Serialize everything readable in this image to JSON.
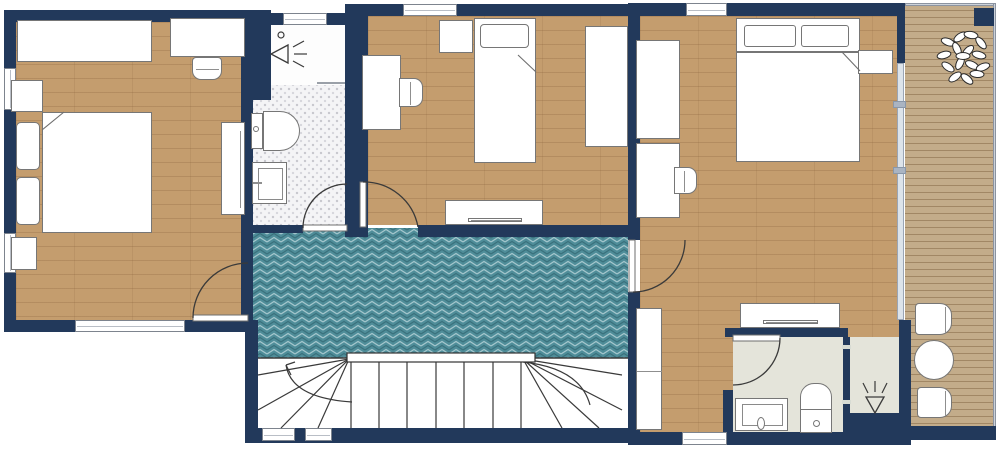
{
  "meta": {
    "title": "apartment-upper-floor-plan",
    "visible_text": []
  },
  "colors": {
    "wall": "#22395b",
    "wood": "#c49d6e",
    "deck": "#c3ac8a",
    "teal": "#4f8d99",
    "tile": "#f4f4f6",
    "ensuite": "#e4e4da",
    "floorwhite": "#fdfdfd",
    "furnborder": "#767676",
    "line": "#3a3a3a",
    "glass": "#dce3ea"
  },
  "plan": {
    "floors": [
      {
        "name": "bedroom-left",
        "type": "wood",
        "rect": [
          16,
          22,
          225,
          298
        ]
      },
      {
        "name": "bathroom1-shower",
        "type": "white",
        "rect": [
          271,
          25,
          74,
          60
        ]
      },
      {
        "name": "bathroom1-tile",
        "type": "tile",
        "rect": [
          253,
          85,
          92,
          143
        ]
      },
      {
        "name": "bedroom-middle",
        "type": "wood",
        "rect": [
          368,
          16,
          260,
          209
        ]
      },
      {
        "name": "hallway",
        "type": "herringbone",
        "rect": [
          253,
          228,
          375,
          130
        ]
      },
      {
        "name": "stairwell",
        "type": "stairs",
        "rect": [
          258,
          358,
          370,
          70
        ]
      },
      {
        "name": "bedroom-right",
        "type": "wood",
        "rect": [
          640,
          16,
          261,
          416
        ]
      },
      {
        "name": "ensuite-main",
        "type": "ensuite",
        "rect": [
          733,
          337,
          110,
          96
        ]
      },
      {
        "name": "ensuite-shower",
        "type": "ensuite",
        "rect": [
          850,
          337,
          55,
          76
        ]
      },
      {
        "name": "balcony-deck",
        "type": "deck",
        "rect": [
          905,
          3,
          91,
          429
        ]
      }
    ],
    "walls": [
      {
        "name": "wall-top-left",
        "rect": [
          4,
          10,
          249,
          12
        ]
      },
      {
        "name": "wall-left",
        "rect": [
          4,
          10,
          12,
          322
        ]
      },
      {
        "name": "wall-bottom-left",
        "rect": [
          4,
          320,
          249,
          12
        ]
      },
      {
        "name": "wall-bedroom1-right",
        "rect": [
          241,
          10,
          12,
          322
        ]
      },
      {
        "name": "wall-shower1-block",
        "rect": [
          241,
          10,
          30,
          90
        ]
      },
      {
        "name": "wall-bath1-top",
        "rect": [
          253,
          13,
          102,
          12
        ]
      },
      {
        "name": "wall-bath1-right",
        "rect": [
          345,
          4,
          23,
          233
        ]
      },
      {
        "name": "wall-middle-top",
        "rect": [
          348,
          4,
          292,
          12
        ]
      },
      {
        "name": "wall-middle-bottom-a",
        "rect": [
          355,
          225,
          7,
          12
        ]
      },
      {
        "name": "wall-middle-bottom-b",
        "rect": [
          418,
          225,
          222,
          12
        ]
      },
      {
        "name": "wall-bath1-bottom",
        "rect": [
          253,
          225,
          50,
          8
        ]
      },
      {
        "name": "wall-stairs-left",
        "rect": [
          245,
          320,
          13,
          123
        ]
      },
      {
        "name": "wall-stairs-bottom",
        "rect": [
          245,
          428,
          395,
          15
        ]
      },
      {
        "name": "wall-divider-upper",
        "rect": [
          628,
          4,
          12,
          236
        ]
      },
      {
        "name": "wall-divider-lower",
        "rect": [
          628,
          292,
          12,
          153
        ]
      },
      {
        "name": "wall-right-top",
        "rect": [
          628,
          3,
          277,
          13
        ]
      },
      {
        "name": "wall-right-bottom",
        "rect": [
          628,
          432,
          283,
          13
        ]
      },
      {
        "name": "wall-balcony-upper",
        "rect": [
          897,
          3,
          8,
          60
        ]
      },
      {
        "name": "wall-balcony-lower",
        "rect": [
          899,
          320,
          12,
          125
        ]
      },
      {
        "name": "wall-ensuite-top",
        "rect": [
          725,
          328,
          123,
          9
        ]
      },
      {
        "name": "wall-ensuite-left",
        "rect": [
          723,
          390,
          10,
          43
        ]
      },
      {
        "name": "wall-ensuite-divider",
        "rect": [
          843,
          337,
          7,
          96
        ]
      },
      {
        "name": "wall-shower2-bottom",
        "rect": [
          848,
          413,
          63,
          32
        ]
      },
      {
        "name": "wall-balcony-bottom",
        "rect": [
          905,
          426,
          91,
          14
        ]
      },
      {
        "name": "wall-balcony-pillar",
        "rect": [
          974,
          8,
          20,
          18
        ]
      }
    ],
    "windows": [
      {
        "name": "window-bedroom1-left-a",
        "rect": [
          4,
          68,
          12,
          42
        ]
      },
      {
        "name": "window-bedroom1-left-b",
        "rect": [
          4,
          233,
          12,
          40
        ]
      },
      {
        "name": "window-bedroom1-bottom",
        "rect": [
          75,
          320,
          110,
          12
        ]
      },
      {
        "name": "window-bathroom1-top",
        "rect": [
          283,
          13,
          44,
          12
        ]
      },
      {
        "name": "window-bedroom2-top",
        "rect": [
          403,
          4,
          54,
          12
        ]
      },
      {
        "name": "window-bedroom3-top",
        "rect": [
          686,
          3,
          41,
          13
        ]
      },
      {
        "name": "window-bedroom3-bottom",
        "rect": [
          682,
          432,
          45,
          13
        ]
      },
      {
        "name": "window-stairwell-a",
        "rect": [
          262,
          428,
          33,
          13
        ]
      },
      {
        "name": "window-stairwell-b",
        "rect": [
          305,
          428,
          27,
          13
        ]
      }
    ],
    "glass_door": {
      "name": "balcony-sliding-door",
      "rect": [
        897,
        63,
        7,
        257
      ],
      "handles": [
        [
          893,
          101,
          13,
          7
        ],
        [
          893,
          167,
          13,
          7
        ]
      ]
    },
    "railings": [
      {
        "name": "balcony-railing-top",
        "rect": [
          905,
          3,
          91,
          3
        ]
      },
      {
        "name": "balcony-railing-right",
        "rect": [
          993,
          3,
          3,
          434
        ]
      }
    ],
    "furniture": [
      {
        "name": "bedroom1-wardrobe",
        "rect": [
          17,
          20,
          135,
          42
        ]
      },
      {
        "name": "bedroom1-desk",
        "rect": [
          170,
          18,
          75,
          39
        ]
      },
      {
        "name": "bedroom1-desk-chair",
        "rect": [
          192,
          57,
          30,
          23
        ],
        "radius": "4px 4px 9px 9px",
        "bar": [
          3,
          11,
          23,
          1
        ]
      },
      {
        "name": "bedroom1-nightstand-a",
        "rect": [
          11,
          80,
          32,
          32
        ]
      },
      {
        "name": "bedroom1-pillow-a",
        "rect": [
          16,
          122,
          24,
          48
        ],
        "radius": "5px"
      },
      {
        "name": "bedroom1-pillow-b",
        "rect": [
          16,
          177,
          24,
          48
        ],
        "radius": "5px"
      },
      {
        "name": "bedroom1-double-bed",
        "rect": [
          42,
          112,
          110,
          121
        ]
      },
      {
        "name": "bedroom1-tall-cabinet",
        "rect": [
          221,
          122,
          24,
          93
        ],
        "bar": [
          18,
          8,
          1,
          77
        ]
      },
      {
        "name": "bedroom1-nightstand-b",
        "rect": [
          11,
          237,
          26,
          33
        ]
      },
      {
        "name": "bathroom1-toilet-tank",
        "rect": [
          251,
          113,
          12,
          36
        ]
      },
      {
        "name": "bathroom1-toilet-bowl",
        "rect": [
          263,
          111,
          37,
          40
        ],
        "radius": "0 20px 20px 0"
      },
      {
        "name": "bathroom1-toilet-button",
        "rect": [
          253,
          126,
          6,
          6
        ],
        "radius": "50%"
      },
      {
        "name": "bathroom1-sink",
        "rect": [
          252,
          162,
          35,
          42
        ],
        "inner": [
          5,
          5,
          25,
          32
        ],
        "bar": [
          0,
          19,
          9,
          2
        ]
      },
      {
        "name": "bedroom2-cabinet",
        "rect": [
          439,
          20,
          34,
          33
        ]
      },
      {
        "name": "bedroom2-single-bed",
        "rect": [
          474,
          18,
          62,
          145
        ]
      },
      {
        "name": "bedroom2-pillow",
        "rect": [
          480,
          24,
          49,
          24
        ],
        "radius": "4px"
      },
      {
        "name": "bedroom2-desk",
        "rect": [
          362,
          55,
          39,
          75
        ]
      },
      {
        "name": "bedroom2-desk-chair",
        "rect": [
          399,
          78,
          24,
          29
        ],
        "radius": "0 9px 9px 0",
        "bar": [
          10,
          3,
          1,
          23
        ]
      },
      {
        "name": "bedroom2-wardrobe",
        "rect": [
          585,
          26,
          43,
          121
        ]
      },
      {
        "name": "bedroom2-tv-cabinet",
        "rect": [
          445,
          200,
          98,
          25
        ]
      },
      {
        "name": "bedroom2-tv",
        "rect": [
          468,
          218,
          54,
          4
        ],
        "bar": [
          2,
          1,
          50,
          1
        ]
      },
      {
        "name": "bedroom3-wardrobe-a",
        "rect": [
          636,
          40,
          44,
          99
        ]
      },
      {
        "name": "bedroom3-desk",
        "rect": [
          636,
          143,
          44,
          75
        ]
      },
      {
        "name": "bedroom3-desk-chair",
        "rect": [
          674,
          167,
          23,
          27
        ],
        "radius": "0 9px 9px 0",
        "bar": [
          9,
          3,
          1,
          21
        ]
      },
      {
        "name": "bedroom3-headboard",
        "rect": [
          736,
          18,
          124,
          34
        ]
      },
      {
        "name": "bedroom3-pillow-a",
        "rect": [
          744,
          25,
          52,
          22
        ],
        "radius": "3px"
      },
      {
        "name": "bedroom3-pillow-b",
        "rect": [
          801,
          25,
          48,
          22
        ],
        "radius": "3px"
      },
      {
        "name": "bedroom3-double-bed",
        "rect": [
          736,
          52,
          124,
          110
        ]
      },
      {
        "name": "bedroom3-nightstand",
        "rect": [
          858,
          50,
          35,
          24
        ]
      },
      {
        "name": "bedroom3-wardrobe-b",
        "rect": [
          636,
          308,
          26,
          122
        ],
        "bar": [
          0,
          62,
          25,
          1
        ]
      },
      {
        "name": "bedroom3-tv-cabinet",
        "rect": [
          740,
          303,
          100,
          25
        ]
      },
      {
        "name": "bedroom3-tv",
        "rect": [
          763,
          320,
          55,
          4
        ],
        "bar": [
          2,
          1,
          51,
          1
        ]
      },
      {
        "name": "ensuite-sink",
        "rect": [
          735,
          398,
          53,
          33
        ],
        "inner": [
          6,
          5,
          41,
          22
        ]
      },
      {
        "name": "ensuite-sink-handle",
        "rect": [
          757,
          417,
          8,
          13
        ],
        "radius": "50%"
      },
      {
        "name": "ensuite-toilet-bowl",
        "rect": [
          800,
          383,
          32,
          29
        ],
        "radius": "14px 14px 0 0"
      },
      {
        "name": "ensuite-toilet-base",
        "rect": [
          800,
          409,
          32,
          24
        ]
      },
      {
        "name": "ensuite-toilet-button",
        "rect": [
          813,
          420,
          7,
          7
        ],
        "radius": "50%"
      },
      {
        "name": "balcony-chair-a",
        "rect": [
          915,
          303,
          37,
          32
        ],
        "radius": "4px 12px 12px 4px",
        "bar": [
          29,
          3,
          1,
          26
        ]
      },
      {
        "name": "balcony-table",
        "rect": [
          914,
          340,
          40,
          40
        ],
        "radius": "50%"
      },
      {
        "name": "balcony-chair-b",
        "rect": [
          917,
          387,
          35,
          31
        ],
        "radius": "4px 12px 12px 4px",
        "bar": [
          27,
          3,
          1,
          25
        ]
      }
    ],
    "doors": [
      {
        "name": "door-bedroom1",
        "leaf": [
          193,
          315,
          55,
          6
        ],
        "arc": "M 193,318 A 55,55 0 0 1 248,263"
      },
      {
        "name": "door-bathroom1",
        "leaf": [
          303,
          225,
          44,
          6
        ],
        "arc": "M 303,228 A 44,44 0 0 1 347,184"
      },
      {
        "name": "door-bedroom2",
        "leaf": [
          360,
          182,
          6,
          45
        ],
        "arc": "M 418,227 A 55,55 0 0 0 363,182"
      },
      {
        "name": "door-bedroom3",
        "leaf": [
          629,
          240,
          6,
          52
        ],
        "arc": "M 633,292 A 52,52 0 0 0 685,240"
      },
      {
        "name": "door-ensuite",
        "leaf": [
          733,
          335,
          47,
          6
        ],
        "arc": "M 780,338 A 47,47 0 0 1 733,385"
      }
    ],
    "stairs": {
      "name": "staircase",
      "area": [
        258,
        358,
        370,
        70
      ],
      "verticals": [
        351,
        379,
        407,
        436,
        464,
        493,
        521
      ],
      "fans": [
        {
          "from": [
            349,
            359
          ],
          "to": [
            [
              258,
              375
            ],
            [
              258,
              410
            ],
            [
              281,
              428
            ],
            [
              318,
              428
            ]
          ]
        },
        {
          "from": [
            523,
            359
          ],
          "to": [
            [
              622,
              375
            ],
            [
              622,
              410
            ],
            [
              599,
              428
            ],
            [
              562,
              428
            ]
          ]
        }
      ],
      "topline": [
        258,
        358,
        628,
        358
      ],
      "handrail": [
        347,
        353,
        188,
        9
      ],
      "walklines": [
        "M 286,365 Q 291,398 352,402",
        "M 523,362 Q 580,368 590,405"
      ],
      "arrow": {
        "tip": [
          286,
          365
        ],
        "wings": [
          [
            295,
            362
          ],
          [
            291,
            375
          ]
        ]
      }
    },
    "icons": {
      "shower1": {
        "name": "shower-head-icon",
        "circle": [
          281,
          35,
          3
        ],
        "triangle": "288,45 288,63 271,54",
        "sprays": [
          [
            293,
            47,
            304,
            41
          ],
          [
            294,
            54,
            307,
            54
          ],
          [
            293,
            61,
            304,
            67
          ]
        ],
        "partition": [
          317,
          83,
          345,
          83
        ]
      },
      "shower2": {
        "name": "shower-head-icon",
        "triangle": "866,397 884,397 875,413",
        "sprays": [
          [
            868,
            393,
            863,
            383
          ],
          [
            875,
            392,
            875,
            381
          ],
          [
            882,
            393,
            887,
            383
          ]
        ]
      },
      "folds": [
        [
          64,
          112,
          42,
          130
        ],
        [
          518,
          55,
          536,
          72
        ],
        [
          842,
          52,
          860,
          71
        ]
      ],
      "divider_ticks": [
        [
          842,
          345,
          9,
          4
        ],
        [
          842,
          400,
          9,
          4
        ]
      ],
      "tree": {
        "name": "plant-icon",
        "leaf_rx": 7,
        "leaf_ry": 3.5,
        "leaves": [
          [
            948,
            42,
            20
          ],
          [
            960,
            37,
            -35
          ],
          [
            971,
            35,
            10
          ],
          [
            981,
            43,
            50
          ],
          [
            944,
            55,
            -15
          ],
          [
            957,
            49,
            65
          ],
          [
            968,
            51,
            -45
          ],
          [
            979,
            55,
            15
          ],
          [
            948,
            67,
            35
          ],
          [
            960,
            63,
            -65
          ],
          [
            972,
            65,
            25
          ],
          [
            983,
            67,
            -20
          ],
          [
            955,
            77,
            -35
          ],
          [
            967,
            79,
            40
          ],
          [
            977,
            74,
            5
          ],
          [
            963,
            56,
            0
          ]
        ]
      }
    }
  }
}
